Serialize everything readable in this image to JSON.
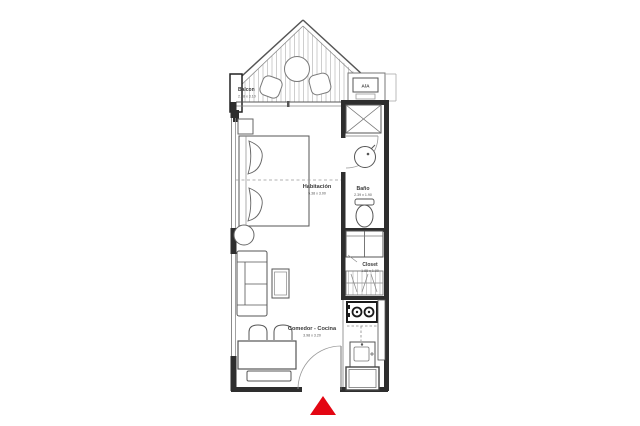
{
  "plan": {
    "title": "apartment-floor-plan",
    "colors": {
      "accent": "#e30613",
      "wall": "#2e2e2e",
      "line": "#555555",
      "hatch": "#c9c9c9"
    },
    "balcony": {
      "label": "Balcon",
      "dims": "2.38 x 3.10"
    },
    "ac": {
      "label": "A/A"
    },
    "bedroom": {
      "label": "Habitación",
      "dims": "5.38 x 3.00"
    },
    "bathroom": {
      "label": "Baño",
      "dims": "2.39 x 1.90"
    },
    "closet": {
      "label": "Closet",
      "dims": "1.85 x 1.00"
    },
    "living": {
      "label": "Comedor - Cocina",
      "dims": "3.98 x 3.20"
    }
  }
}
